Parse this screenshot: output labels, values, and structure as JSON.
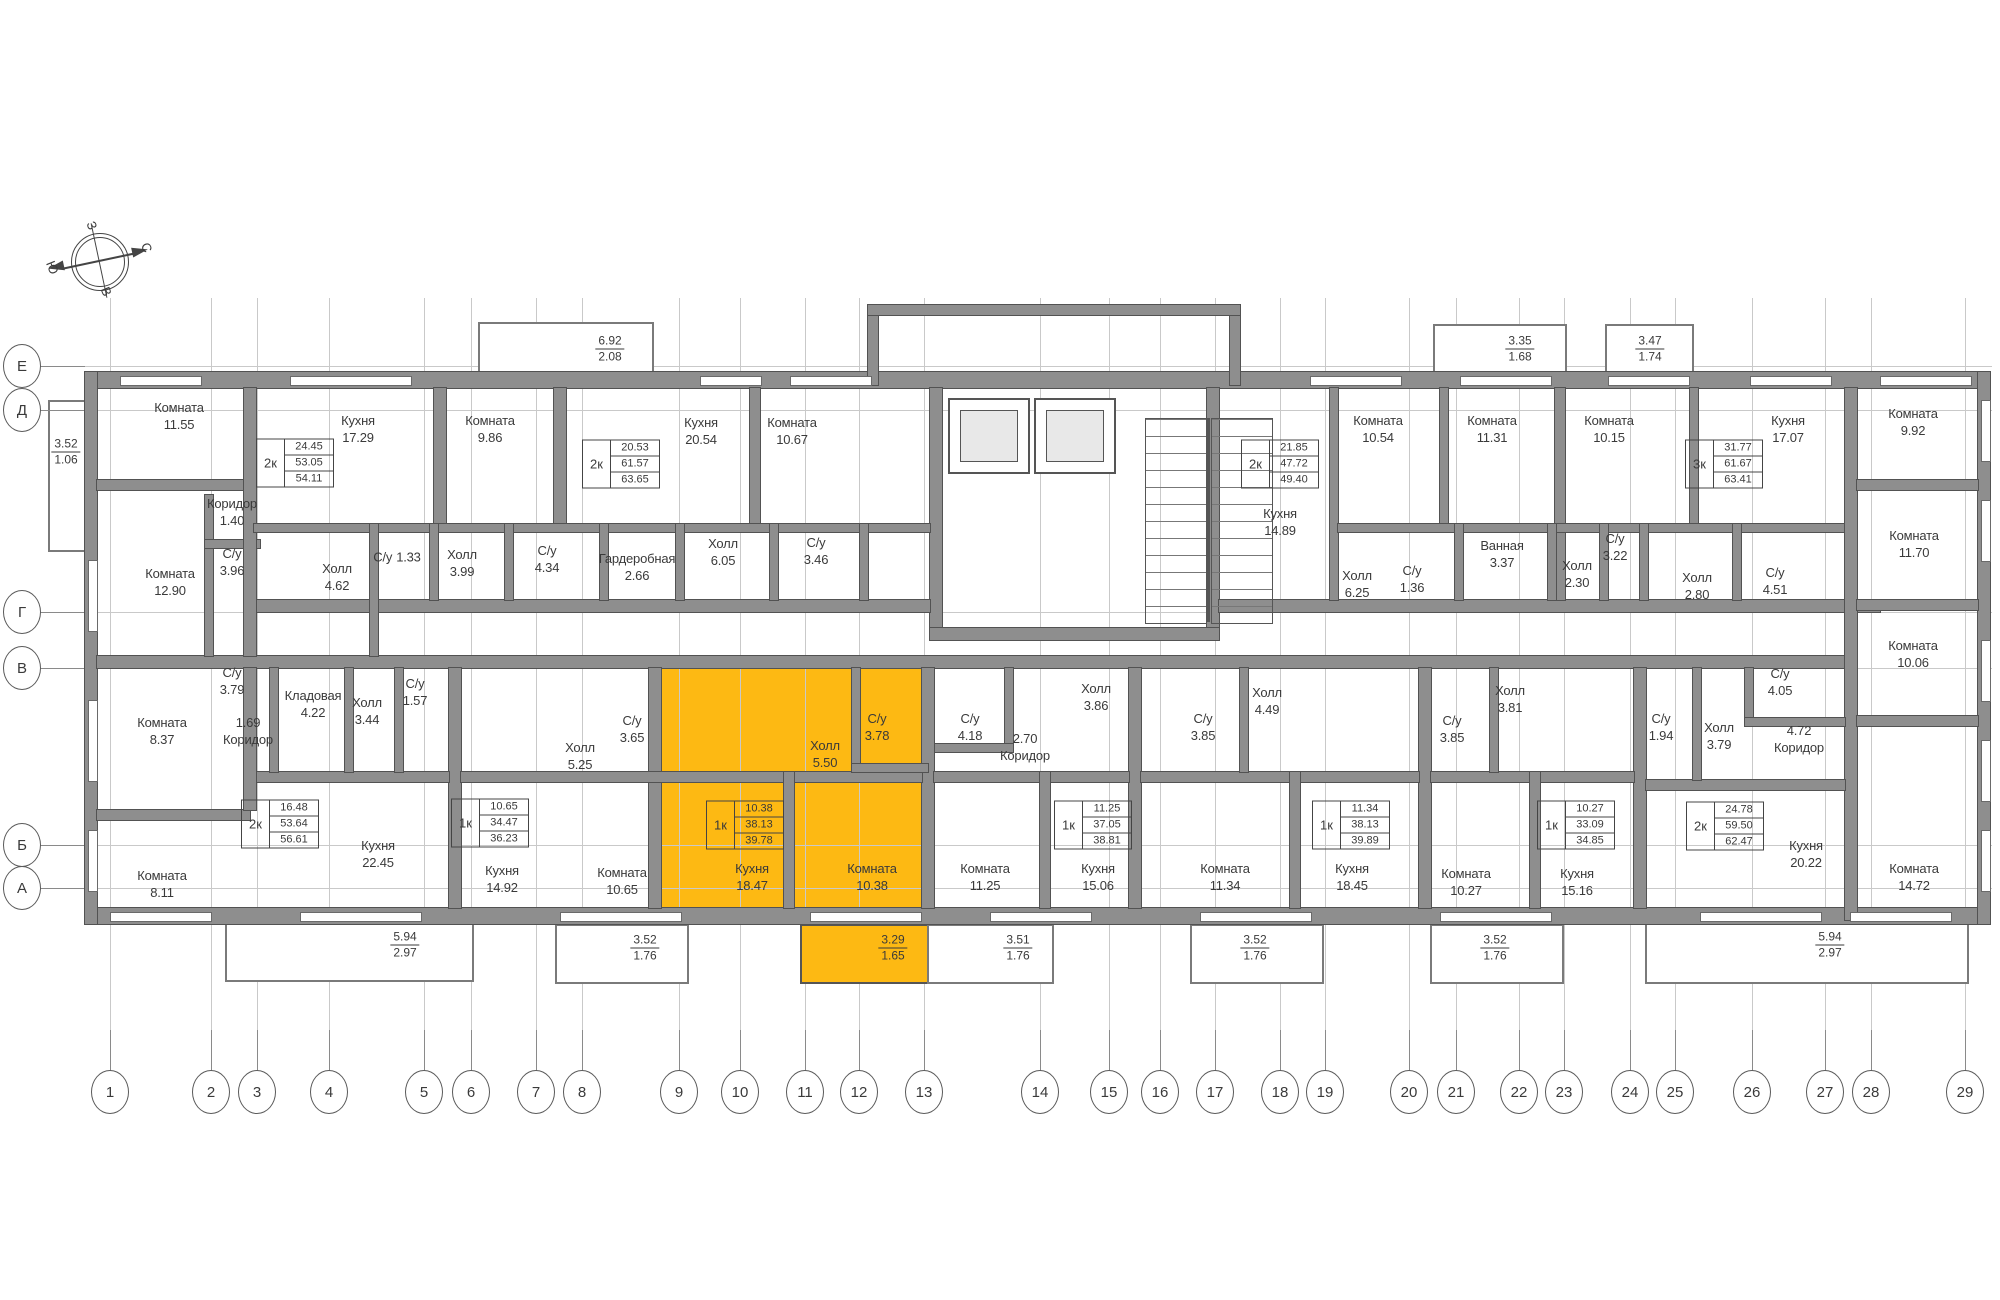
{
  "highlight_color": "#FDB913",
  "compass": {
    "west": "З",
    "north": "С",
    "south": "Ю",
    "east": "В"
  },
  "grid": {
    "rows": [
      {
        "label": "Е",
        "y": 366
      },
      {
        "label": "Д",
        "y": 410
      },
      {
        "label": "Г",
        "y": 612
      },
      {
        "label": "В",
        "y": 668
      },
      {
        "label": "Б",
        "y": 845
      },
      {
        "label": "А",
        "y": 888
      }
    ],
    "cols": [
      {
        "label": "1",
        "x": 110
      },
      {
        "label": "2",
        "x": 211
      },
      {
        "label": "3",
        "x": 257
      },
      {
        "label": "4",
        "x": 329
      },
      {
        "label": "5",
        "x": 424
      },
      {
        "label": "6",
        "x": 471
      },
      {
        "label": "7",
        "x": 536
      },
      {
        "label": "8",
        "x": 582
      },
      {
        "label": "9",
        "x": 679
      },
      {
        "label": "10",
        "x": 740
      },
      {
        "label": "11",
        "x": 805
      },
      {
        "label": "12",
        "x": 859
      },
      {
        "label": "13",
        "x": 924
      },
      {
        "label": "14",
        "x": 1040
      },
      {
        "label": "15",
        "x": 1109
      },
      {
        "label": "16",
        "x": 1160
      },
      {
        "label": "17",
        "x": 1215
      },
      {
        "label": "18",
        "x": 1280
      },
      {
        "label": "19",
        "x": 1325
      },
      {
        "label": "20",
        "x": 1409
      },
      {
        "label": "21",
        "x": 1456
      },
      {
        "label": "22",
        "x": 1519
      },
      {
        "label": "23",
        "x": 1564
      },
      {
        "label": "24",
        "x": 1630
      },
      {
        "label": "25",
        "x": 1675
      },
      {
        "label": "26",
        "x": 1752
      },
      {
        "label": "27",
        "x": 1825
      },
      {
        "label": "28",
        "x": 1871
      },
      {
        "label": "29",
        "x": 1965
      }
    ]
  },
  "rooms": [
    {
      "name": "Комната",
      "area": "11.55",
      "x": 179,
      "y": 417
    },
    {
      "name": "Кухня",
      "area": "17.29",
      "x": 358,
      "y": 430
    },
    {
      "name": "Комната",
      "area": "9.86",
      "x": 490,
      "y": 430
    },
    {
      "name": "Кухня",
      "area": "20.54",
      "x": 701,
      "y": 432
    },
    {
      "name": "Комната",
      "area": "10.67",
      "x": 792,
      "y": 432
    },
    {
      "name": "Комната",
      "area": "10.54",
      "x": 1378,
      "y": 430
    },
    {
      "name": "Кухня",
      "area": "14.89",
      "x": 1280,
      "y": 523
    },
    {
      "name": "Комната",
      "area": "11.31",
      "x": 1492,
      "y": 430
    },
    {
      "name": "Комната",
      "area": "10.15",
      "x": 1609,
      "y": 430
    },
    {
      "name": "Кухня",
      "area": "17.07",
      "x": 1788,
      "y": 430
    },
    {
      "name": "Комната",
      "area": "9.92",
      "x": 1913,
      "y": 423
    },
    {
      "name": "Комната",
      "area": "11.70",
      "x": 1914,
      "y": 545
    },
    {
      "name": "Коридор",
      "area": "1.40",
      "x": 232,
      "y": 513
    },
    {
      "name": "С/у",
      "area": "3.96",
      "x": 232,
      "y": 563
    },
    {
      "name": "Комната",
      "area": "12.90",
      "x": 170,
      "y": 583
    },
    {
      "name": "Холл",
      "area": "4.62",
      "x": 337,
      "y": 578
    },
    {
      "name": "С/у",
      "area": "1.33",
      "x": 397,
      "y": 558,
      "inline": true
    },
    {
      "name": "Холл",
      "area": "3.99",
      "x": 462,
      "y": 564
    },
    {
      "name": "С/у",
      "area": "4.34",
      "x": 547,
      "y": 560
    },
    {
      "name": "Гардеробная",
      "area": "2.66",
      "x": 637,
      "y": 568
    },
    {
      "name": "Холл",
      "area": "6.05",
      "x": 723,
      "y": 553
    },
    {
      "name": "С/у",
      "area": "3.46",
      "x": 816,
      "y": 552
    },
    {
      "name": "Холл",
      "area": "6.25",
      "x": 1357,
      "y": 585
    },
    {
      "name": "С/у",
      "area": "1.36",
      "x": 1412,
      "y": 580
    },
    {
      "name": "Ванная",
      "area": "3.37",
      "x": 1502,
      "y": 555
    },
    {
      "name": "Холл",
      "area": "2.30",
      "x": 1577,
      "y": 575
    },
    {
      "name": "С/у",
      "area": "3.22",
      "x": 1615,
      "y": 548
    },
    {
      "name": "Холл",
      "area": "2.80",
      "x": 1697,
      "y": 587
    },
    {
      "name": "С/у",
      "area": "4.51",
      "x": 1775,
      "y": 582
    },
    {
      "name": "С/у",
      "area": "3.79",
      "x": 232,
      "y": 682
    },
    {
      "name": "Кладовая",
      "area": "4.22",
      "x": 313,
      "y": 705
    },
    {
      "name": "Холл",
      "area": "3.44",
      "x": 367,
      "y": 712
    },
    {
      "name": "С/у",
      "area": "1.57",
      "x": 415,
      "y": 693
    },
    {
      "name": "Коридор",
      "area": "1.69",
      "x": 248,
      "y": 732,
      "area_first": true
    },
    {
      "name": "Комната",
      "area": "8.37",
      "x": 162,
      "y": 732
    },
    {
      "name": "Комната",
      "area": "8.11",
      "x": 162,
      "y": 885
    },
    {
      "name": "Кухня",
      "area": "22.45",
      "x": 378,
      "y": 855
    },
    {
      "name": "Холл",
      "area": "5.25",
      "x": 580,
      "y": 757
    },
    {
      "name": "С/у",
      "area": "3.65",
      "x": 632,
      "y": 730
    },
    {
      "name": "Кухня",
      "area": "14.92",
      "x": 502,
      "y": 880
    },
    {
      "name": "Комната",
      "area": "10.65",
      "x": 622,
      "y": 882
    },
    {
      "name": "Кухня",
      "area": "18.47",
      "x": 752,
      "y": 878,
      "hl": true
    },
    {
      "name": "Холл",
      "area": "5.50",
      "x": 825,
      "y": 755,
      "hl": true
    },
    {
      "name": "С/у",
      "area": "3.78",
      "x": 877,
      "y": 728,
      "hl": true
    },
    {
      "name": "Комната",
      "area": "10.38",
      "x": 872,
      "y": 878,
      "hl": true
    },
    {
      "name": "С/у",
      "area": "4.18",
      "x": 970,
      "y": 728
    },
    {
      "name": "Коридор",
      "area": "2.70",
      "x": 1025,
      "y": 748,
      "area_first": true
    },
    {
      "name": "Холл",
      "area": "3.86",
      "x": 1096,
      "y": 698
    },
    {
      "name": "Комната",
      "area": "11.25",
      "x": 985,
      "y": 878
    },
    {
      "name": "Кухня",
      "area": "15.06",
      "x": 1098,
      "y": 878
    },
    {
      "name": "С/у",
      "area": "3.85",
      "x": 1203,
      "y": 728
    },
    {
      "name": "Холл",
      "area": "4.49",
      "x": 1267,
      "y": 702
    },
    {
      "name": "Комната",
      "area": "11.34",
      "x": 1225,
      "y": 878
    },
    {
      "name": "Кухня",
      "area": "18.45",
      "x": 1352,
      "y": 878
    },
    {
      "name": "С/у",
      "area": "3.85",
      "x": 1452,
      "y": 730
    },
    {
      "name": "Холл",
      "area": "3.81",
      "x": 1510,
      "y": 700
    },
    {
      "name": "Комната",
      "area": "10.27",
      "x": 1466,
      "y": 883
    },
    {
      "name": "Кухня",
      "area": "15.16",
      "x": 1577,
      "y": 883
    },
    {
      "name": "С/у",
      "area": "1.94",
      "x": 1661,
      "y": 728
    },
    {
      "name": "Холл",
      "area": "3.79",
      "x": 1719,
      "y": 737
    },
    {
      "name": "С/у",
      "area": "4.05",
      "x": 1780,
      "y": 683
    },
    {
      "name": "Коридор",
      "area": "4.72",
      "x": 1799,
      "y": 740,
      "area_first": true
    },
    {
      "name": "Кухня",
      "area": "20.22",
      "x": 1806,
      "y": 855
    },
    {
      "name": "Комната",
      "area": "14.72",
      "x": 1914,
      "y": 878
    },
    {
      "name": "Комната",
      "area": "10.06",
      "x": 1913,
      "y": 655
    }
  ],
  "balcony_labels": [
    {
      "top": "3.52",
      "bottom": "1.06",
      "x": 66,
      "y": 452
    },
    {
      "top": "6.92",
      "bottom": "2.08",
      "x": 610,
      "y": 349
    },
    {
      "top": "3.35",
      "bottom": "1.68",
      "x": 1520,
      "y": 349
    },
    {
      "top": "3.47",
      "bottom": "1.74",
      "x": 1650,
      "y": 349
    },
    {
      "top": "5.94",
      "bottom": "2.97",
      "x": 405,
      "y": 945
    },
    {
      "top": "3.52",
      "bottom": "1.76",
      "x": 645,
      "y": 948
    },
    {
      "top": "3.29",
      "bottom": "1.65",
      "x": 893,
      "y": 948,
      "hl": true
    },
    {
      "top": "3.51",
      "bottom": "1.76",
      "x": 1018,
      "y": 948
    },
    {
      "top": "3.52",
      "bottom": "1.76",
      "x": 1255,
      "y": 948
    },
    {
      "top": "3.52",
      "bottom": "1.76",
      "x": 1495,
      "y": 948
    },
    {
      "top": "5.94",
      "bottom": "2.97",
      "x": 1830,
      "y": 945
    }
  ],
  "apartment_tables": [
    {
      "type": "2к",
      "living": "24.45",
      "total": "53.05",
      "total_with_balcony": "54.11",
      "x": 295,
      "y": 463
    },
    {
      "type": "2к",
      "living": "20.53",
      "total": "61.57",
      "total_with_balcony": "63.65",
      "x": 621,
      "y": 464
    },
    {
      "type": "2к",
      "living": "21.85",
      "total": "47.72",
      "total_with_balcony": "49.40",
      "x": 1280,
      "y": 464
    },
    {
      "type": "3к",
      "living": "31.77",
      "total": "61.67",
      "total_with_balcony": "63.41",
      "x": 1724,
      "y": 464
    },
    {
      "type": "2к",
      "living": "16.48",
      "total": "53.64",
      "total_with_balcony": "56.61",
      "x": 280,
      "y": 824
    },
    {
      "type": "1к",
      "living": "10.65",
      "total": "34.47",
      "total_with_balcony": "36.23",
      "x": 490,
      "y": 823
    },
    {
      "type": "1к",
      "living": "10.38",
      "total": "38.13",
      "total_with_balcony": "39.78",
      "x": 745,
      "y": 825,
      "hl": true
    },
    {
      "type": "1к",
      "living": "11.25",
      "total": "37.05",
      "total_with_balcony": "38.81",
      "x": 1093,
      "y": 825
    },
    {
      "type": "1к",
      "living": "11.34",
      "total": "38.13",
      "total_with_balcony": "39.89",
      "x": 1351,
      "y": 825
    },
    {
      "type": "1к",
      "living": "10.27",
      "total": "33.09",
      "total_with_balcony": "34.85",
      "x": 1576,
      "y": 825
    },
    {
      "type": "2к",
      "living": "24.78",
      "total": "59.50",
      "total_with_balcony": "62.47",
      "x": 1725,
      "y": 826
    }
  ]
}
